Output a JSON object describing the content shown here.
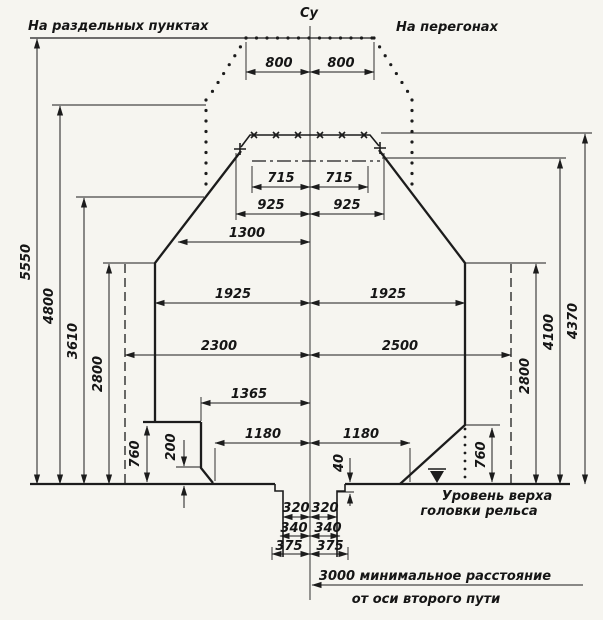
{
  "diagram_title": "Railway structure clearance gauge diagram",
  "colors": {
    "ink": "#1c1c1c",
    "paper": "#f6f5f0"
  },
  "labels": {
    "na_razdelnyh": "На раздельных пунктах",
    "na_peregonah": "На перегонах",
    "su": "Су",
    "urovn1": "Уровень верха",
    "urovn2": "головки рельса",
    "note3000_1": "3000 минимальное расстояние",
    "note3000_2": "от оси второго пути",
    "d800": "800",
    "d715": "715",
    "d925": "925",
    "d1300": "1300",
    "d1925": "1925",
    "d2300": "2300",
    "d2500": "2500",
    "d1365": "1365",
    "d1180": "1180",
    "d320": "320",
    "d340": "340",
    "d375": "375",
    "d200": "200",
    "d40": "40",
    "d760": "760",
    "d2800": "2800",
    "d3610": "3610",
    "d4800": "4800",
    "d5550": "5550",
    "d4100": "4100",
    "d4370": "4370"
  }
}
